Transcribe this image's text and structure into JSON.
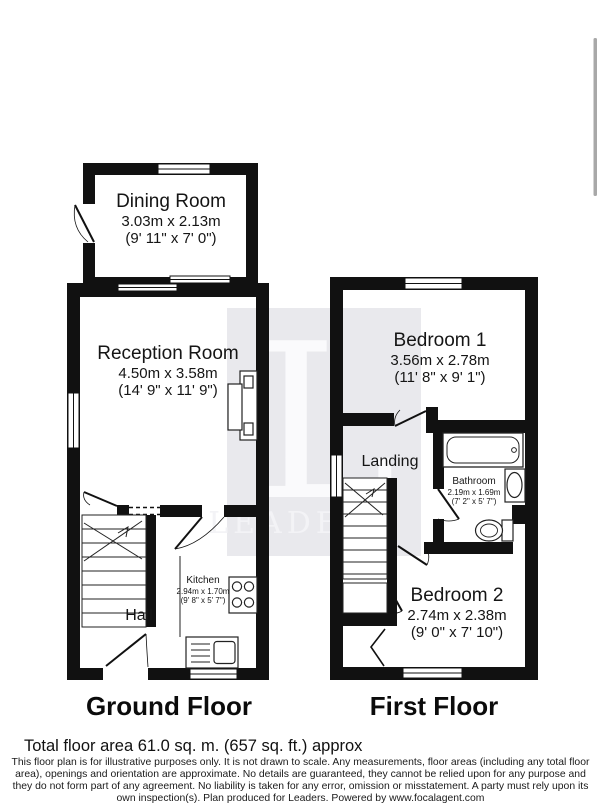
{
  "watermark": {
    "letter": "L",
    "word": "LEADERS"
  },
  "colors": {
    "wall": "#111111",
    "watermark_bg": "#e9e9ed",
    "scrollbar": "#a8a8a8"
  },
  "ground_floor": {
    "label": "Ground Floor",
    "rooms": {
      "dining": {
        "name": "Dining Room",
        "metric": "3.03m x 2.13m",
        "imperial": "(9' 11\" x 7' 0\")"
      },
      "reception": {
        "name": "Reception Room",
        "metric": "4.50m x 3.58m",
        "imperial": "(14' 9\" x 11' 9\")"
      },
      "kitchen": {
        "name": "Kitchen",
        "metric": "2.94m x 1.70m",
        "imperial": "(9' 8\" x 5' 7\")"
      },
      "hall": {
        "name": "Hall"
      }
    }
  },
  "first_floor": {
    "label": "First Floor",
    "rooms": {
      "bedroom1": {
        "name": "Bedroom 1",
        "metric": "3.56m x 2.78m",
        "imperial": "(11' 8\" x 9' 1\")"
      },
      "landing": {
        "name": "Landing"
      },
      "bathroom": {
        "name": "Bathroom",
        "metric": "2.19m x 1.69m",
        "imperial": "(7' 2\" x 5' 7\")"
      },
      "bedroom2": {
        "name": "Bedroom 2",
        "metric": "2.74m x 2.38m",
        "imperial": "(9' 0\" x 7' 10\")"
      }
    }
  },
  "footer": {
    "total_area": "Total floor area 61.0 sq. m. (657 sq. ft.) approx",
    "disclaimer": "This floor plan is for illustrative purposes only. It is not drawn to scale. Any measurements, floor areas (including any total floor area), openings and orientation are approximate. No details are guaranteed, they cannot be relied upon for any purpose and they do not form part of any agreement. No liability is taken for any error, omission or misstatement. A party must rely upon its own inspection(s). Plan produced for Leaders. Powered by www.focalagent.com"
  }
}
